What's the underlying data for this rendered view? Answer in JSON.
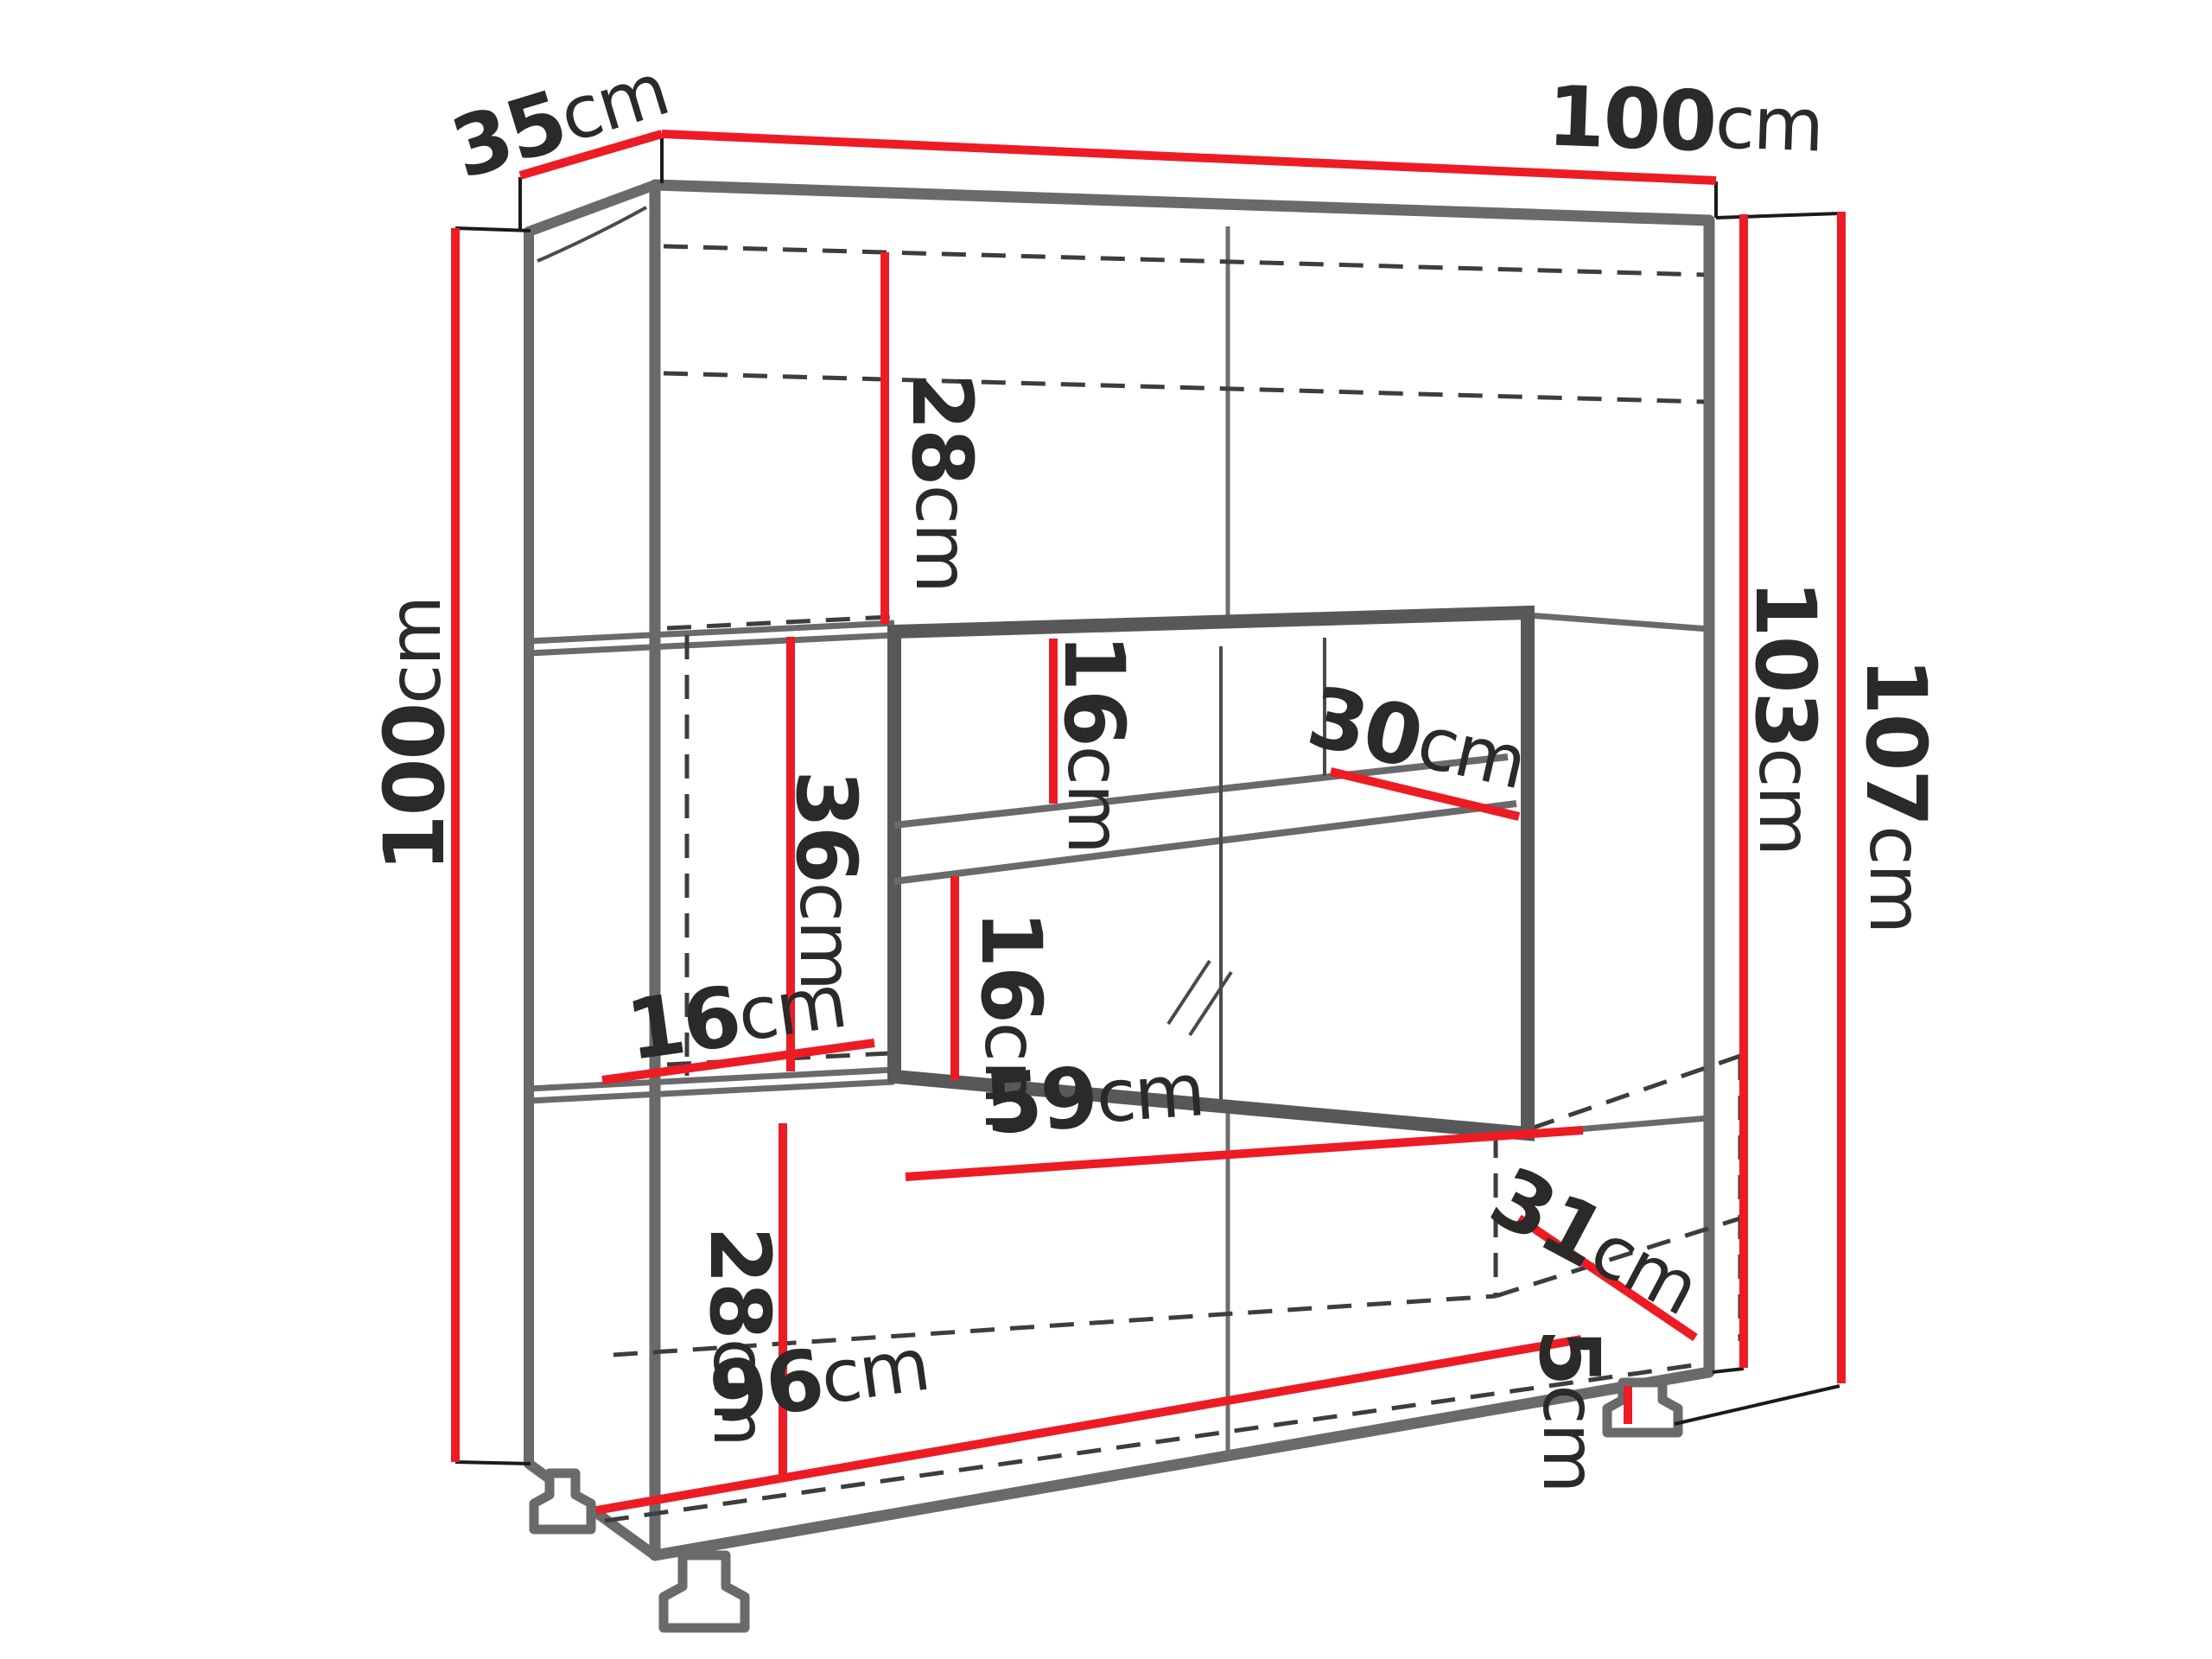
{
  "diagram": {
    "type": "furniture-dimension-drawing",
    "background": "#ffffff",
    "unit": "cm",
    "colors": {
      "dimension_line": "#ed1c24",
      "cabinet_outline": "#6a6a6a",
      "glass_frame": "#58585a",
      "hidden_line": "#3d3d3d",
      "label_text": "#2b2a29"
    },
    "labels": {
      "depth_top": {
        "value": "35",
        "unit": "cm"
      },
      "width_top": {
        "value": "100",
        "unit": "cm"
      },
      "height_front_left": {
        "value": "100",
        "unit": "cm"
      },
      "top_compartment_height": {
        "value": "28",
        "unit": "cm"
      },
      "glass_upper_height": {
        "value": "16",
        "unit": "cm"
      },
      "glass_shelf_depth": {
        "value": "30",
        "unit": "cm"
      },
      "middle_left_height": {
        "value": "36",
        "unit": "cm"
      },
      "middle_left_width": {
        "value": "16",
        "unit": "cm"
      },
      "glass_lower_height": {
        "value": "16",
        "unit": "cm"
      },
      "glass_compartment_width": {
        "value": "59",
        "unit": "cm"
      },
      "body_height_right": {
        "value": "103",
        "unit": "cm"
      },
      "total_height_right": {
        "value": "107",
        "unit": "cm"
      },
      "bottom_compartment_height": {
        "value": "28",
        "unit": "cm"
      },
      "bottom_width": {
        "value": "96",
        "unit": "cm"
      },
      "bottom_depth_right": {
        "value": "31",
        "unit": "cm"
      },
      "leg_height": {
        "value": "5",
        "unit": "cm"
      }
    }
  }
}
